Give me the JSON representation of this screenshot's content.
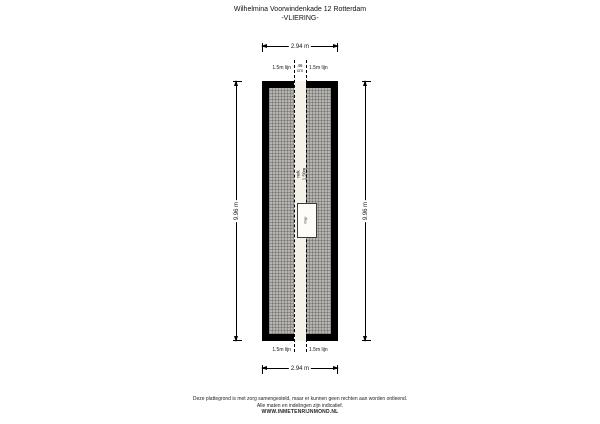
{
  "title": {
    "line1": "Wilhelmina Voorwindenkade 12 Rotterdam",
    "line2": "-VLIERING-"
  },
  "dimensions": {
    "top_width": "2.94 m",
    "bottom_width": "2.94 m",
    "left_height": "9.96 m",
    "right_height": "9.96 m",
    "strip_width_value": "46",
    "strip_width_unit": "cm",
    "lijn_top_left": "1.5m lijn",
    "lijn_top_right": "1.5m lijn",
    "lijn_bottom_left": "1.5m lijn",
    "lijn_bottom_right": "1.5m lijn"
  },
  "plan": {
    "ridge_label_line1": "nok",
    "ridge_label_line2": "1.50m",
    "hatch_object_label": "trap"
  },
  "colors": {
    "wall": "#000000",
    "hatch_base": "#b5b4b0",
    "strip": "#f5f2e9",
    "text": "#111111"
  },
  "footer": {
    "line1": "Deze plattegrond is met zorg samengesteld, maar er kunnen geen rechten aan worden ontleend.",
    "line2": "Alle maten en indelingen zijn indicatief.",
    "line3": "WWW.INMETENRIJNMOND.NL"
  }
}
